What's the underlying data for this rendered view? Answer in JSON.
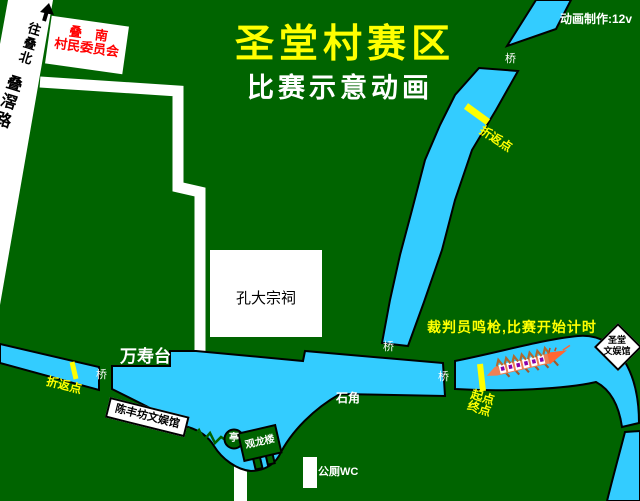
{
  "credit": "动画制作:12v",
  "title": "圣堂村赛区",
  "subtitle": "比赛示意动画",
  "road": {
    "direction": "往叠北",
    "name": "叠滘路"
  },
  "signs": {
    "committee_line1": "叠　南",
    "committee_line2": "村民委员会",
    "chenfeng_hall": "陈丰坊文娱馆",
    "shengtang_hall_line1": "圣堂",
    "shengtang_hall_line2": "文娱馆"
  },
  "places": {
    "ancestral_hall": "孔大宗祠",
    "wanshoutai": "万寿台",
    "pavilion": "亭",
    "dragon_tower": "观龙楼",
    "toilet": "公厕WC",
    "shijiao": "石角"
  },
  "course": {
    "bridge": "桥",
    "turn_point": "折返点",
    "start": "起点",
    "finish": "终点",
    "announcement": "裁判员鸣枪,比赛开始计时"
  },
  "colors": {
    "background": "#006400",
    "water": "#33CCFF",
    "road": "#FFFFFF",
    "highlight": "#FFFF00",
    "committee_text": "#FF0000",
    "boat_hull": "#F08055"
  }
}
